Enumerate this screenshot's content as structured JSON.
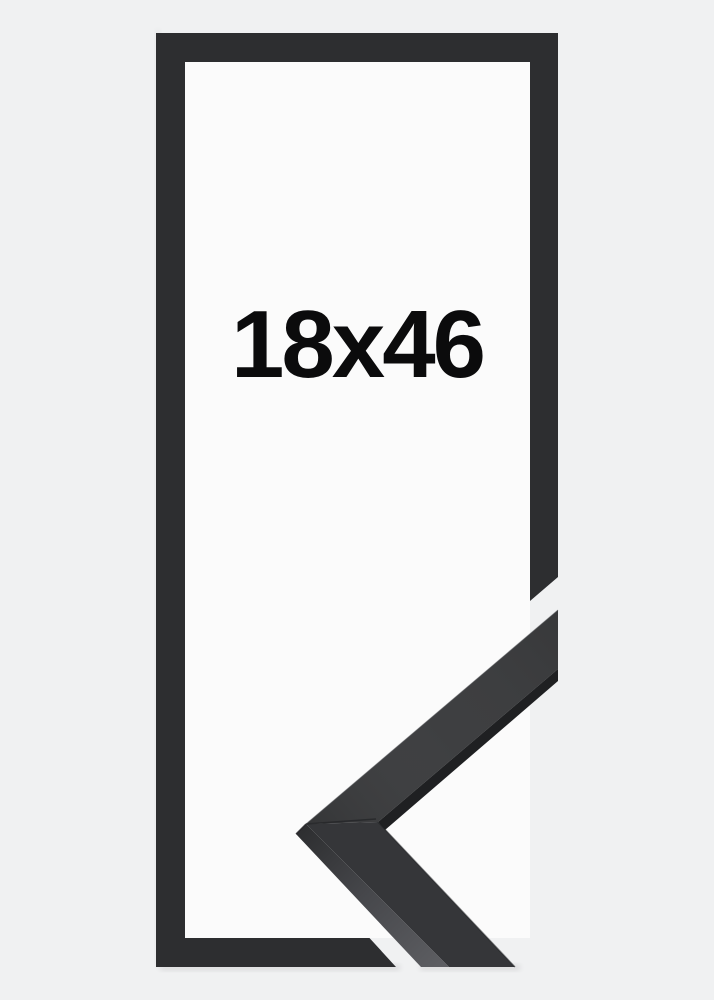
{
  "product_image": {
    "size_label": "18x46",
    "colors": {
      "background": "#f0f1f2",
      "opening": "#fbfbfb",
      "frame": "#2d2e30",
      "face_upper": "#3a3b3d",
      "face_lower": "#353639",
      "edge_dark": "#1f2022",
      "edge_light": "#5e5f63",
      "seam": "#27282a",
      "label_text": "#0b0b0c"
    }
  }
}
